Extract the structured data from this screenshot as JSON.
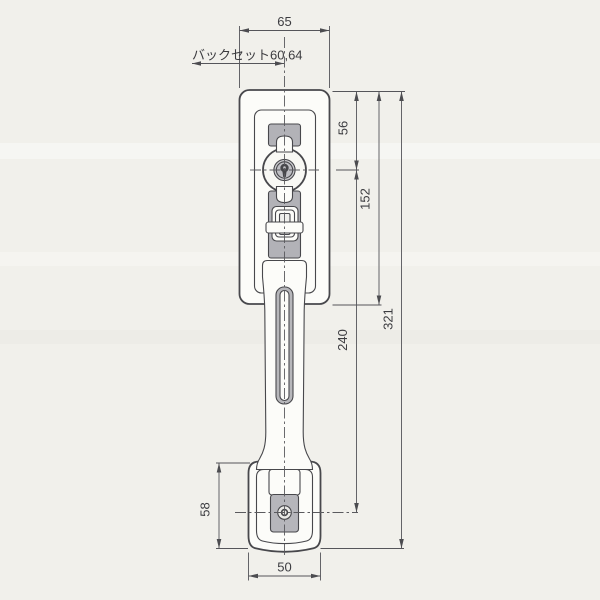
{
  "drawing": {
    "title": "door-handle-lockset-dimension-drawing",
    "dims": {
      "top_width": "65",
      "backset": "バックセット60,64",
      "cylinder_offset": "56",
      "plate_height": "152",
      "overall_height": "321",
      "handle_pitch": "240",
      "base_height": "58",
      "base_width": "50"
    },
    "colors": {
      "paper": "#f1f0eb",
      "line": "#48484c",
      "dimension_line": "#55555a",
      "text": "#3c3c40",
      "shaded_fill": "#b2b2b7",
      "part_fill": "#fcfcf9"
    }
  }
}
